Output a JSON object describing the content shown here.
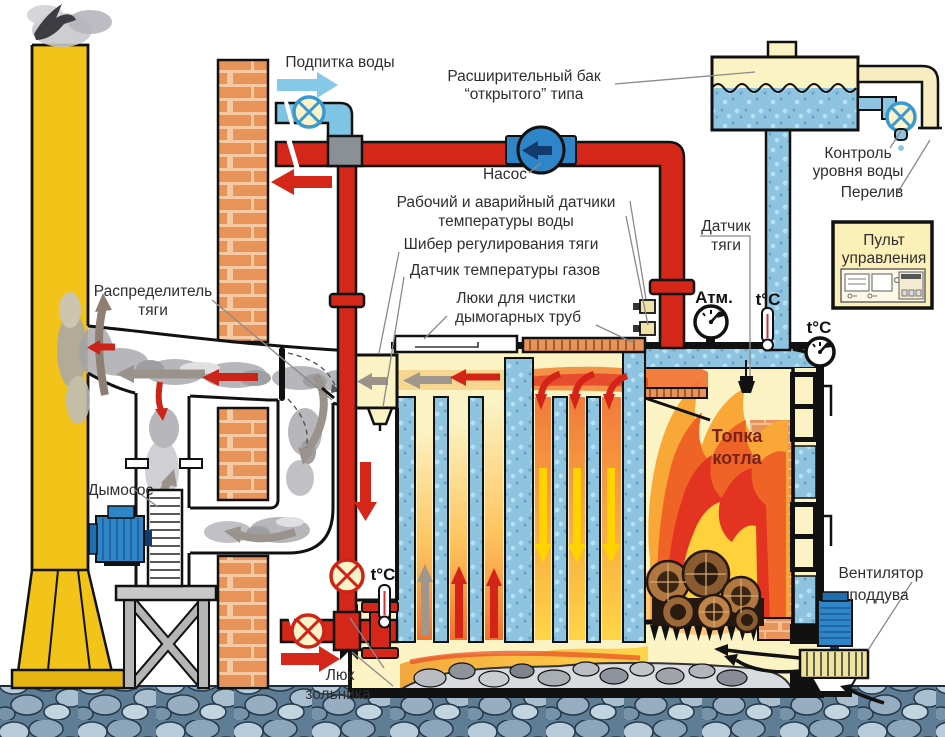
{
  "diagram": {
    "title_hint": "Boiler heating system schematic",
    "labels": {
      "water_makeup": "Подпитка воды",
      "expansion_tank_line1": "Расширительный бак",
      "expansion_tank_line2": "“открытого” типа",
      "pump": "Насос",
      "level_control_line1": "Контроль",
      "level_control_line2": "уровня воды",
      "overflow": "Перелив",
      "water_sensors_line1": "Рабочий и аварийный датчики",
      "water_sensors_line2": "температуры воды",
      "draft_gate": "Шибер регулирования тяги",
      "gas_temp_sensor": "Датчик температуры газов",
      "cleaning_hatches_line1": "Люки для чистки",
      "cleaning_hatches_line2": "дымогарных труб",
      "draft_sensor_line1": "Датчик",
      "draft_sensor_line2": "тяги",
      "atm": "Атм.",
      "temp_c_top": "t°C",
      "temp_c_right": "t°C",
      "temp_c_bottom": "t°C",
      "control_panel_line1": "Пульт",
      "control_panel_line2": "управления",
      "draft_distributor_line1": "Распределитель",
      "draft_distributor_line2": "тяги",
      "smoke_exhauster": "Дымосос",
      "firebox_line1": "Топка",
      "firebox_line2": "котла",
      "blower_line1": "Вентилятор",
      "blower_line2": "поддува",
      "ash_hatch_line1": "Люк",
      "ash_hatch_line2": "зольника"
    },
    "colors": {
      "hot_pipe": "#d42619",
      "cold_pipe": "#7ec4e4",
      "water": "#8fc4e0",
      "flue_gas": "#fbf3c4",
      "chimney": "#f2c318",
      "brick": "#e8935a",
      "smoke": "#9b9ba1",
      "flame_orange": "#f07030",
      "flame_red": "#e23222",
      "flame_yellow": "#ffd23c",
      "panel_bg": "#fbf0b8",
      "motor_blue": "#2e86c8"
    }
  }
}
